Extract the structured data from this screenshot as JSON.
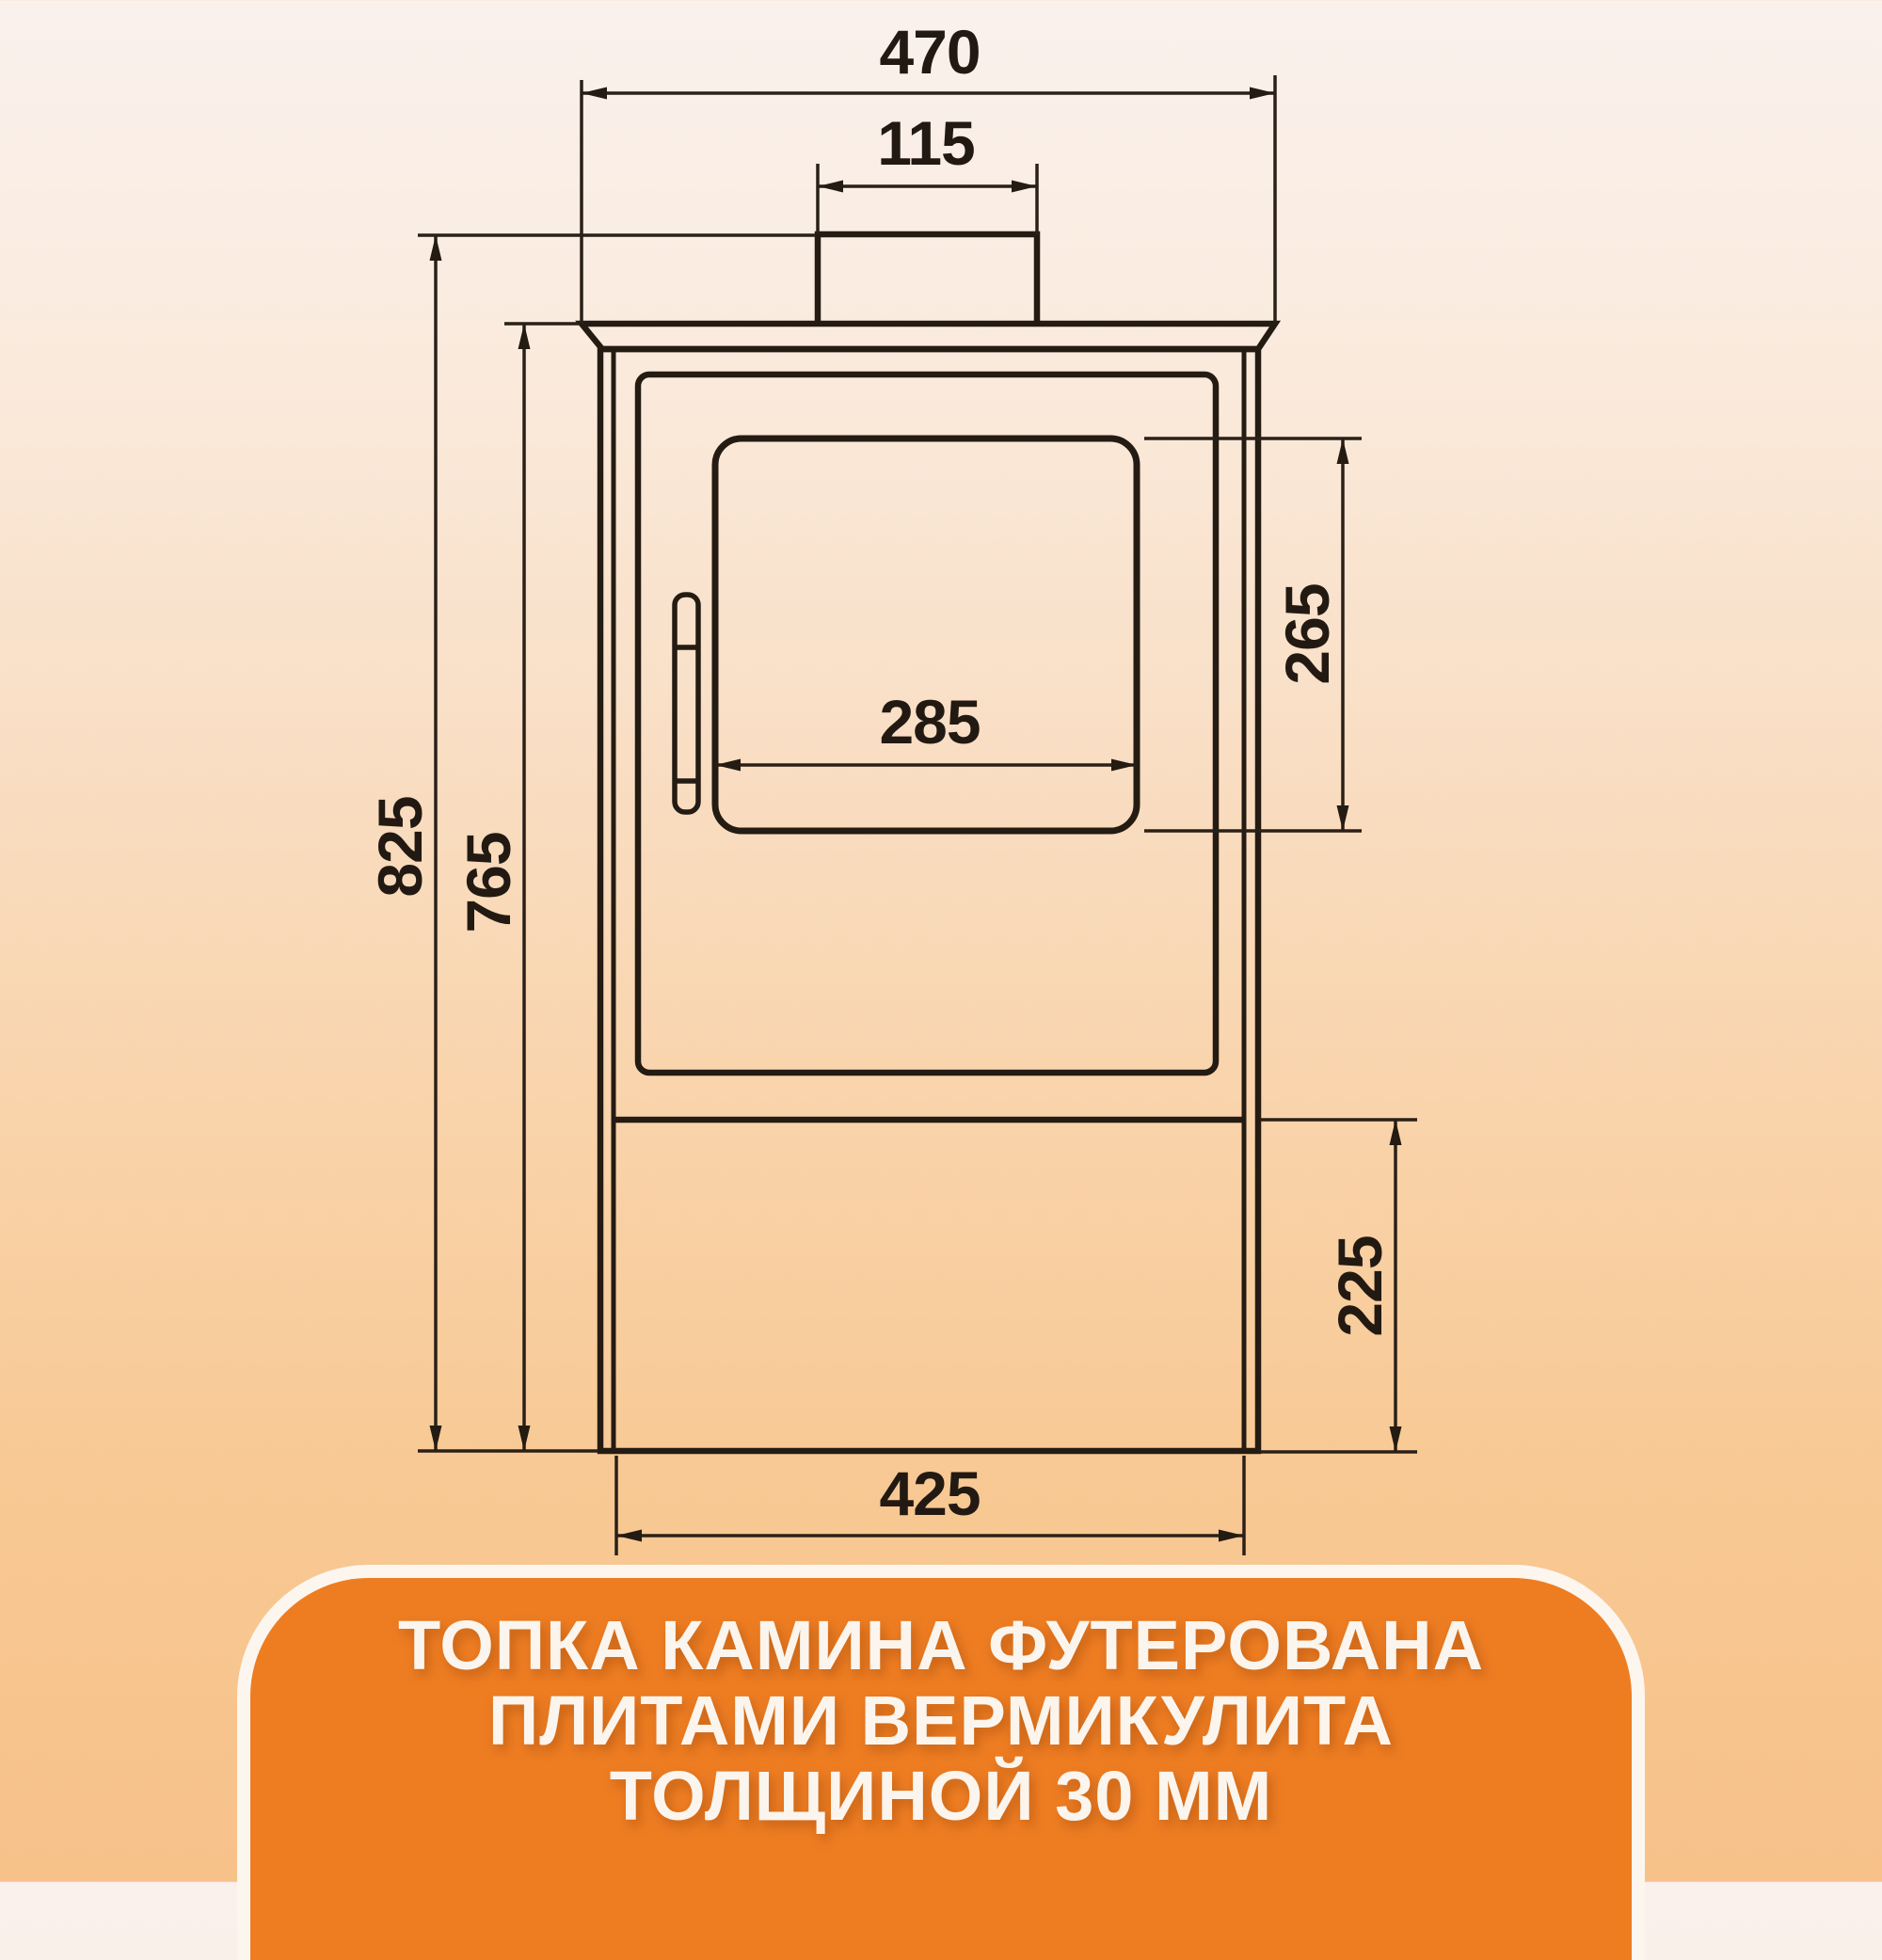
{
  "background": {
    "gradient_top": "#FAF1ED",
    "gradient_bottom": "#F7C18A"
  },
  "drawing": {
    "type": "stove-front-dimension-drawing",
    "line_color": "#241b12",
    "dim_labels": {
      "top_plate_width": "470",
      "flue_diameter": "115",
      "total_height": "825",
      "body_height": "765",
      "glass_height": "265",
      "glass_width": "285",
      "base_height": "225",
      "body_width": "425"
    }
  },
  "caption": {
    "panel_color": "#EE7D22",
    "border_color": "#FCF6EF",
    "text_color": "#FBF5EE",
    "lines": [
      "ТОПКА КАМИНА ФУТЕРОВАНА",
      "ПЛИТАМИ ВЕРМИКУЛИТА",
      "ТОЛЩИНОЙ 30 ММ"
    ]
  }
}
